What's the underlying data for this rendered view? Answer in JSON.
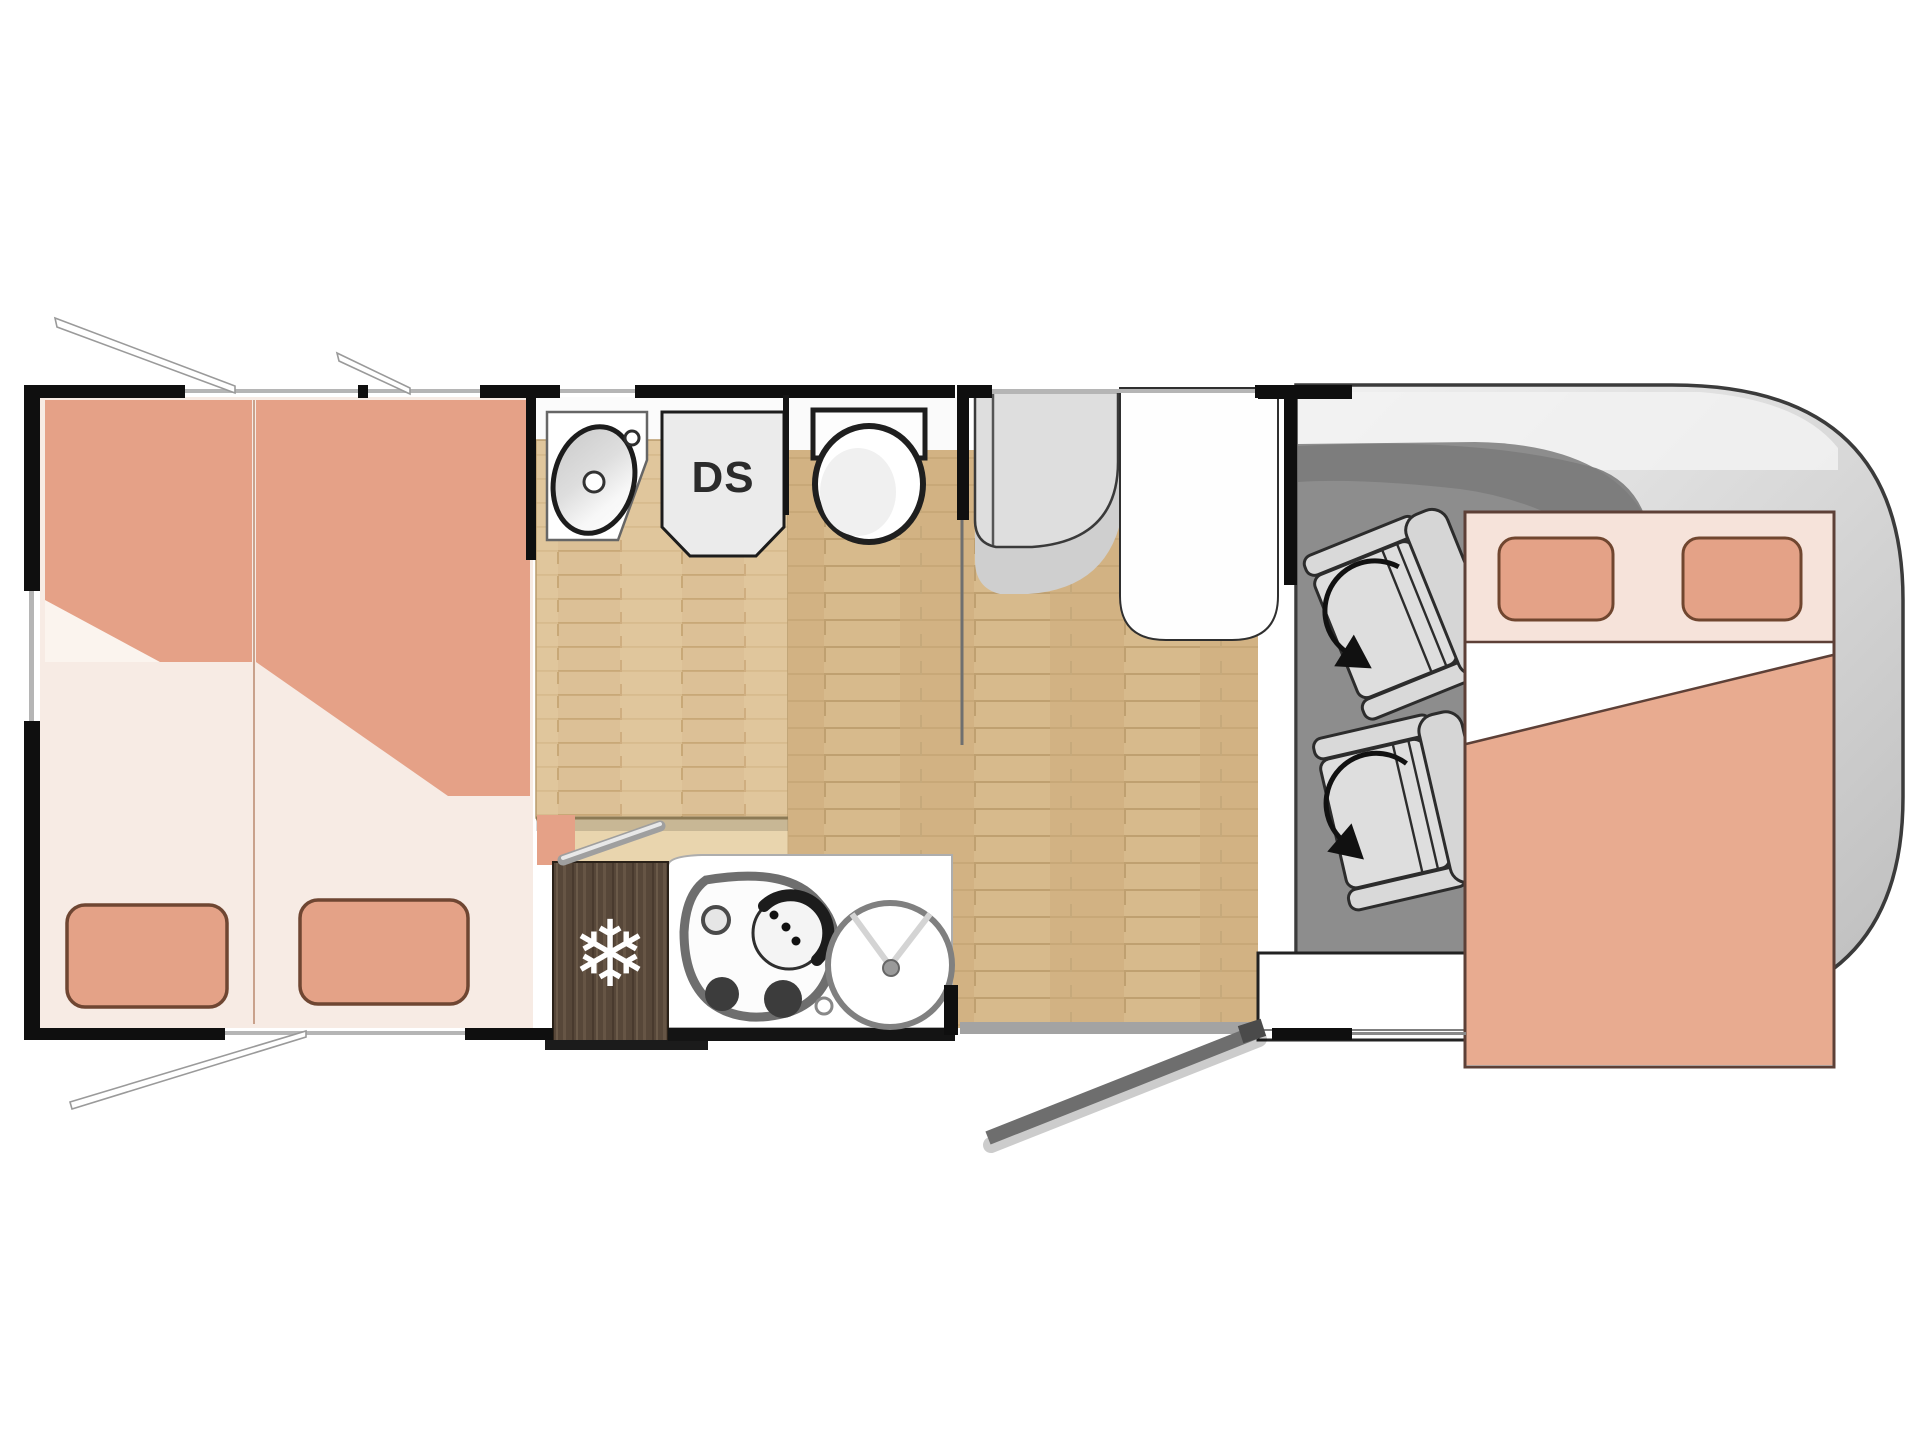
{
  "diagram": {
    "type": "motorhome-floor-plan",
    "labels": {
      "shower": "DS"
    },
    "icons": {
      "fridge_snowflake": "❄"
    },
    "colors": {
      "mattress": "#e5a187",
      "pillow": "#e4a287",
      "bed_base": "#f7ebe4",
      "wood_floor_light": "#dcc096",
      "wood_floor_main": "#d7ba8c",
      "fridge_wood": "#574739",
      "cab_floor": "#8d8d8d",
      "vehicle_body": "#d2d2d2",
      "wall": "#0f0f0f",
      "fixture_white": "#ffffff"
    },
    "areas": {
      "rear": "twin-beds",
      "middle_top": "washroom-basin-shower-toilet",
      "middle_bottom": "kitchen-fridge-hob-sink",
      "front": "cab-with-swivel-seats-and-drop-down-bed"
    }
  }
}
